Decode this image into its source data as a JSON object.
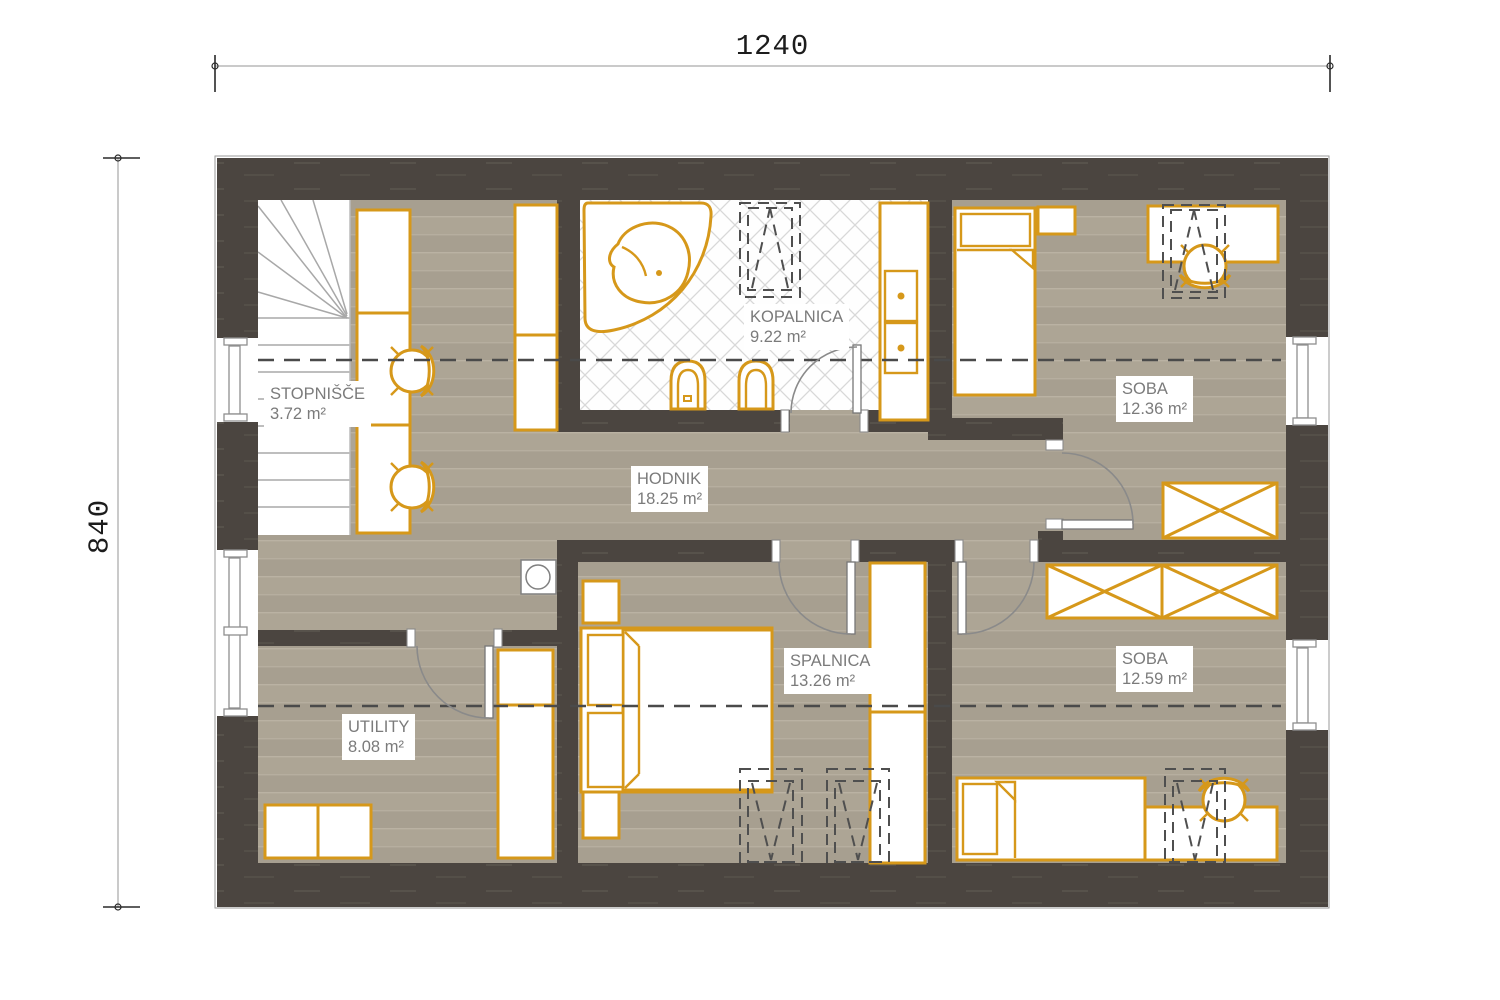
{
  "plan": {
    "dimensions": {
      "width_label": "1240",
      "height_label": "840"
    },
    "rooms": {
      "stopnisce": {
        "name": "STOPNIŠČE",
        "area": "3.72 m²"
      },
      "kopalnica": {
        "name": "KOPALNICA",
        "area": "9.22 m²"
      },
      "soba_top": {
        "name": "SOBA",
        "area": "12.36 m²"
      },
      "hodnik": {
        "name": "HODNIK",
        "area": "18.25 m²"
      },
      "spalnica": {
        "name": "SPALNICA",
        "area": "13.26 m²"
      },
      "soba_bottom": {
        "name": "SOBA",
        "area": "12.59 m²"
      },
      "utility": {
        "name": "UTILITY",
        "area": "8.08 m²"
      }
    },
    "colors": {
      "wall": "#4b4540",
      "floor": "#aba294",
      "furniture_outline": "#d6981a",
      "tile_line": "#d8d8d8",
      "label_text": "#7b7b7b",
      "roof_dash": "#4a4a4a"
    }
  }
}
